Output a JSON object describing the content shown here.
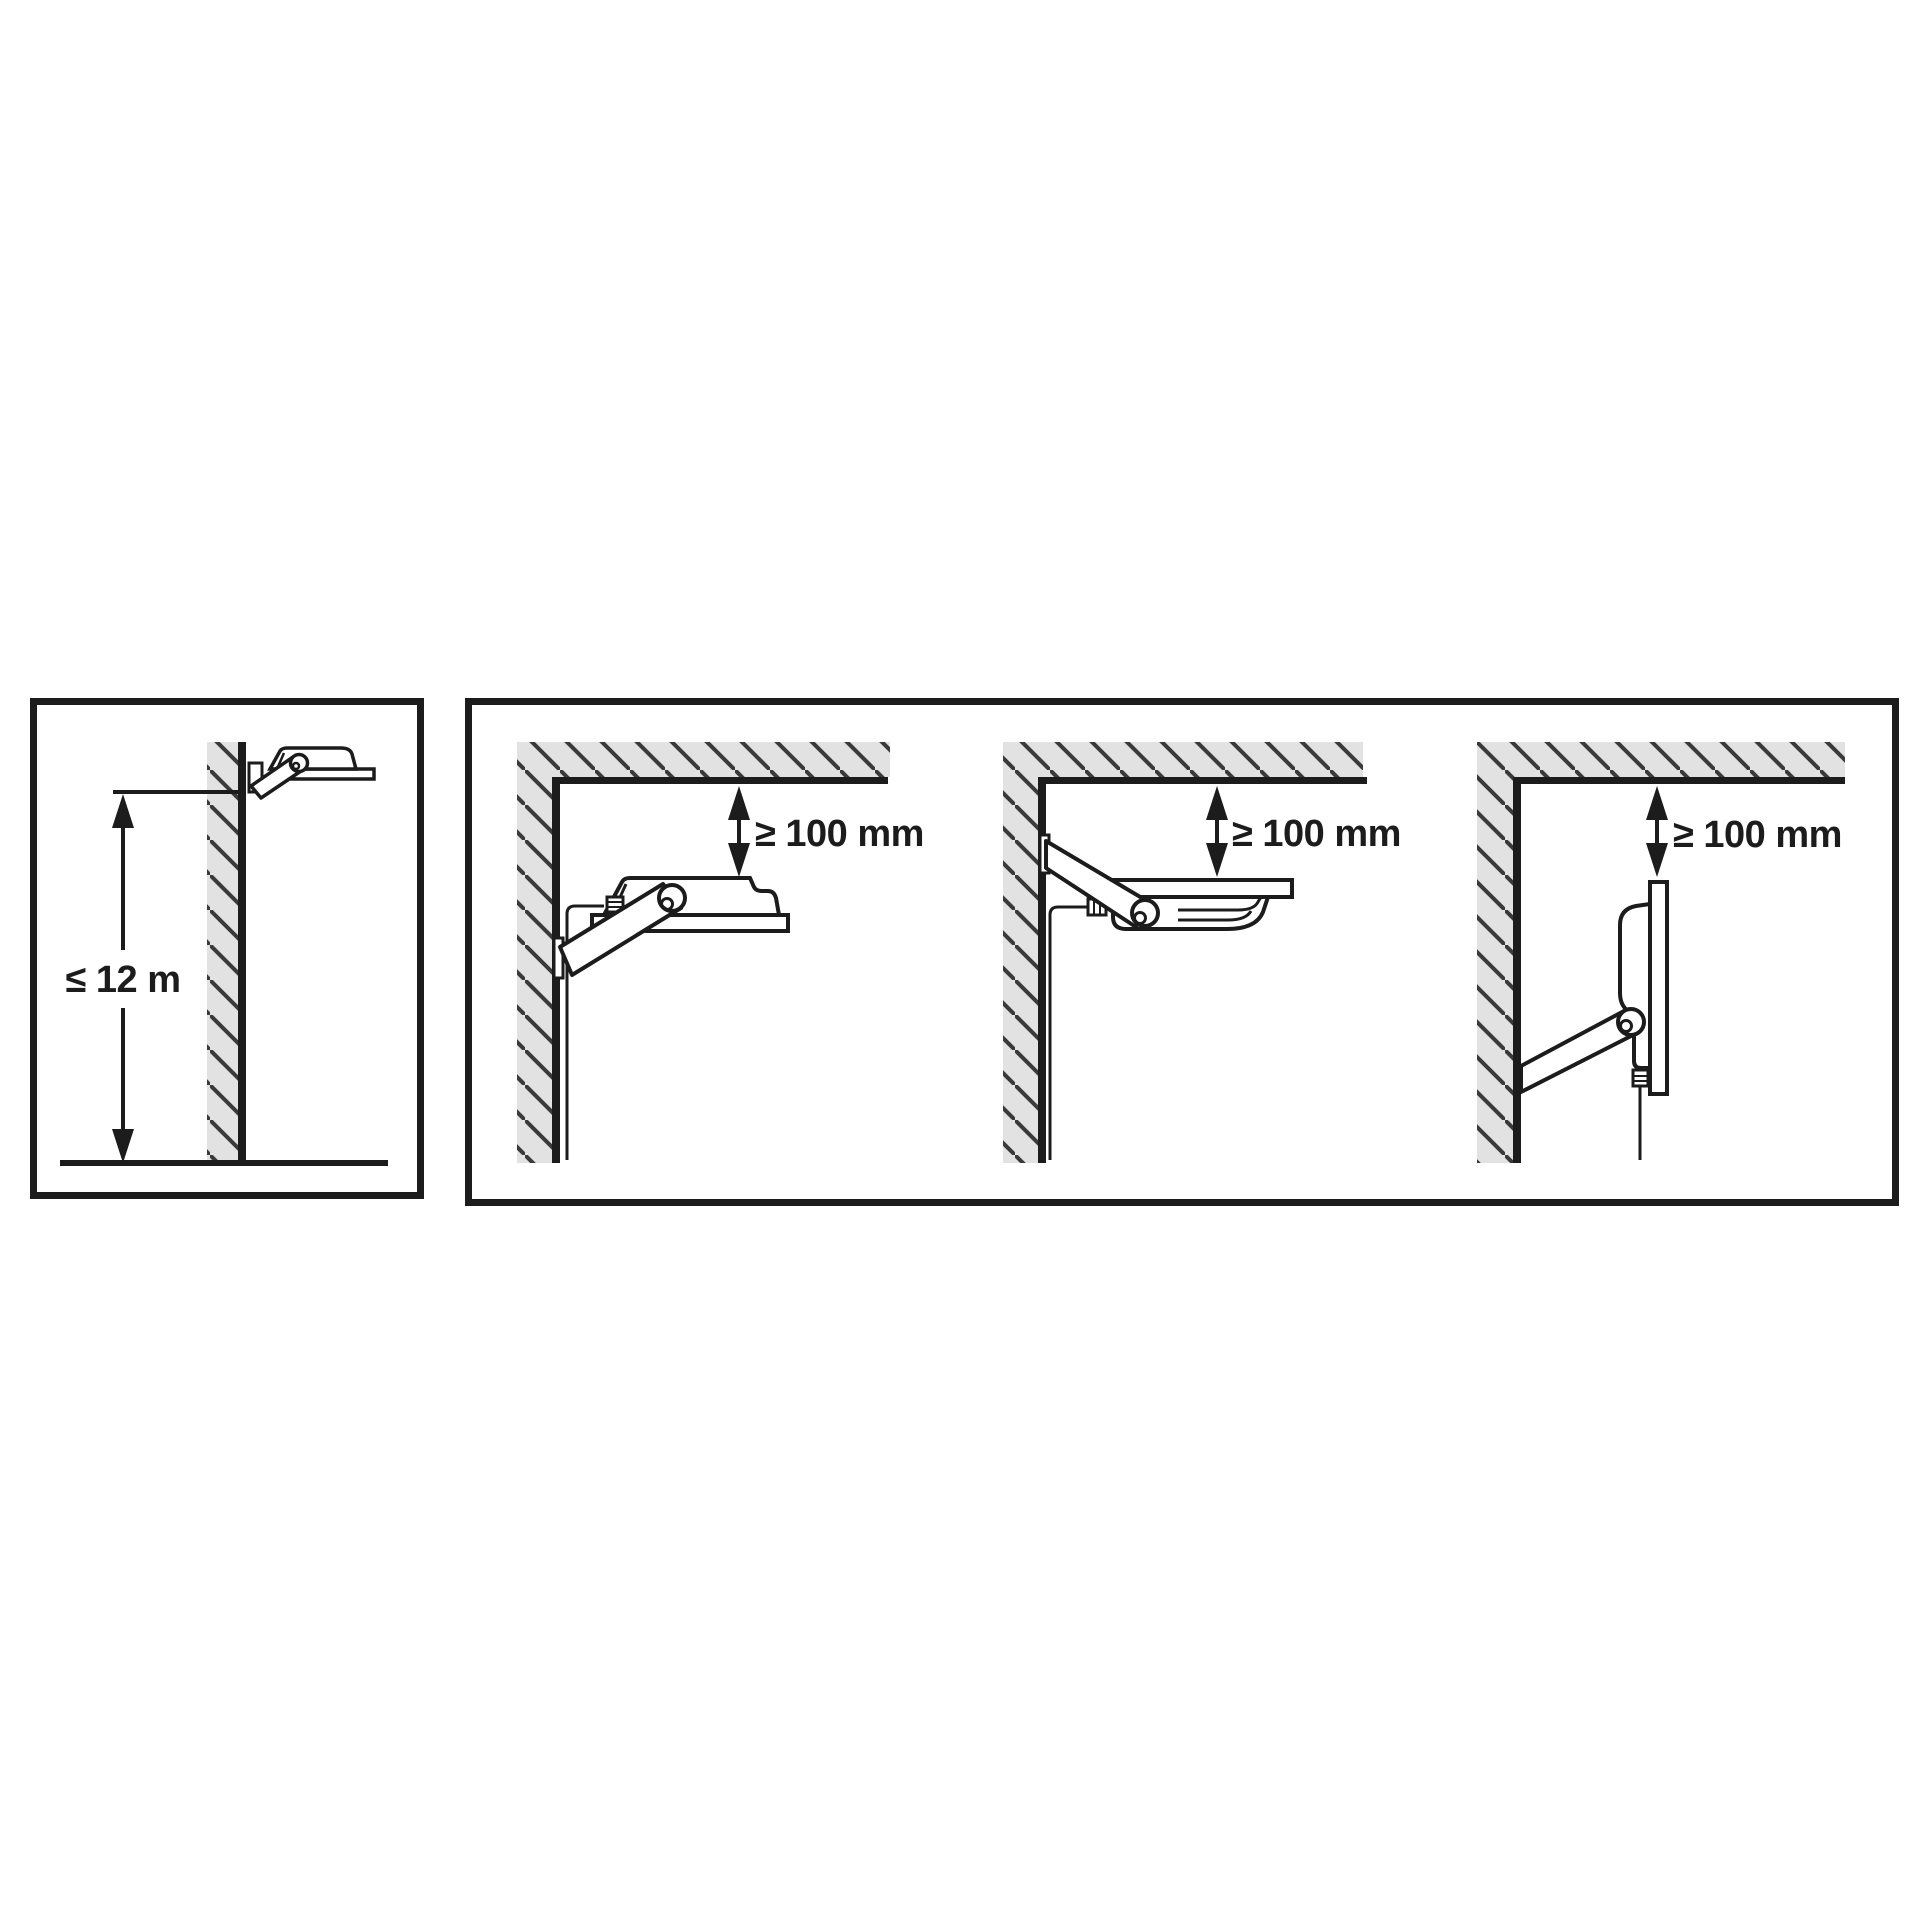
{
  "colors": {
    "background": "#ffffff",
    "line": "#1c1c1c",
    "hatch_fill": "#e2e2e2",
    "hatch_line": "#3a3a3a"
  },
  "left_panel": {
    "height_label": "≤ 12 m"
  },
  "right_panel": {
    "diagrams": [
      {
        "orientation": "floodlight-tilted-up",
        "clearance_label": "≥ 100 mm"
      },
      {
        "orientation": "floodlight-facing-down",
        "clearance_label": "≥ 100 mm"
      },
      {
        "orientation": "floodlight-vertical",
        "clearance_label": "≥ 100 mm"
      }
    ]
  }
}
